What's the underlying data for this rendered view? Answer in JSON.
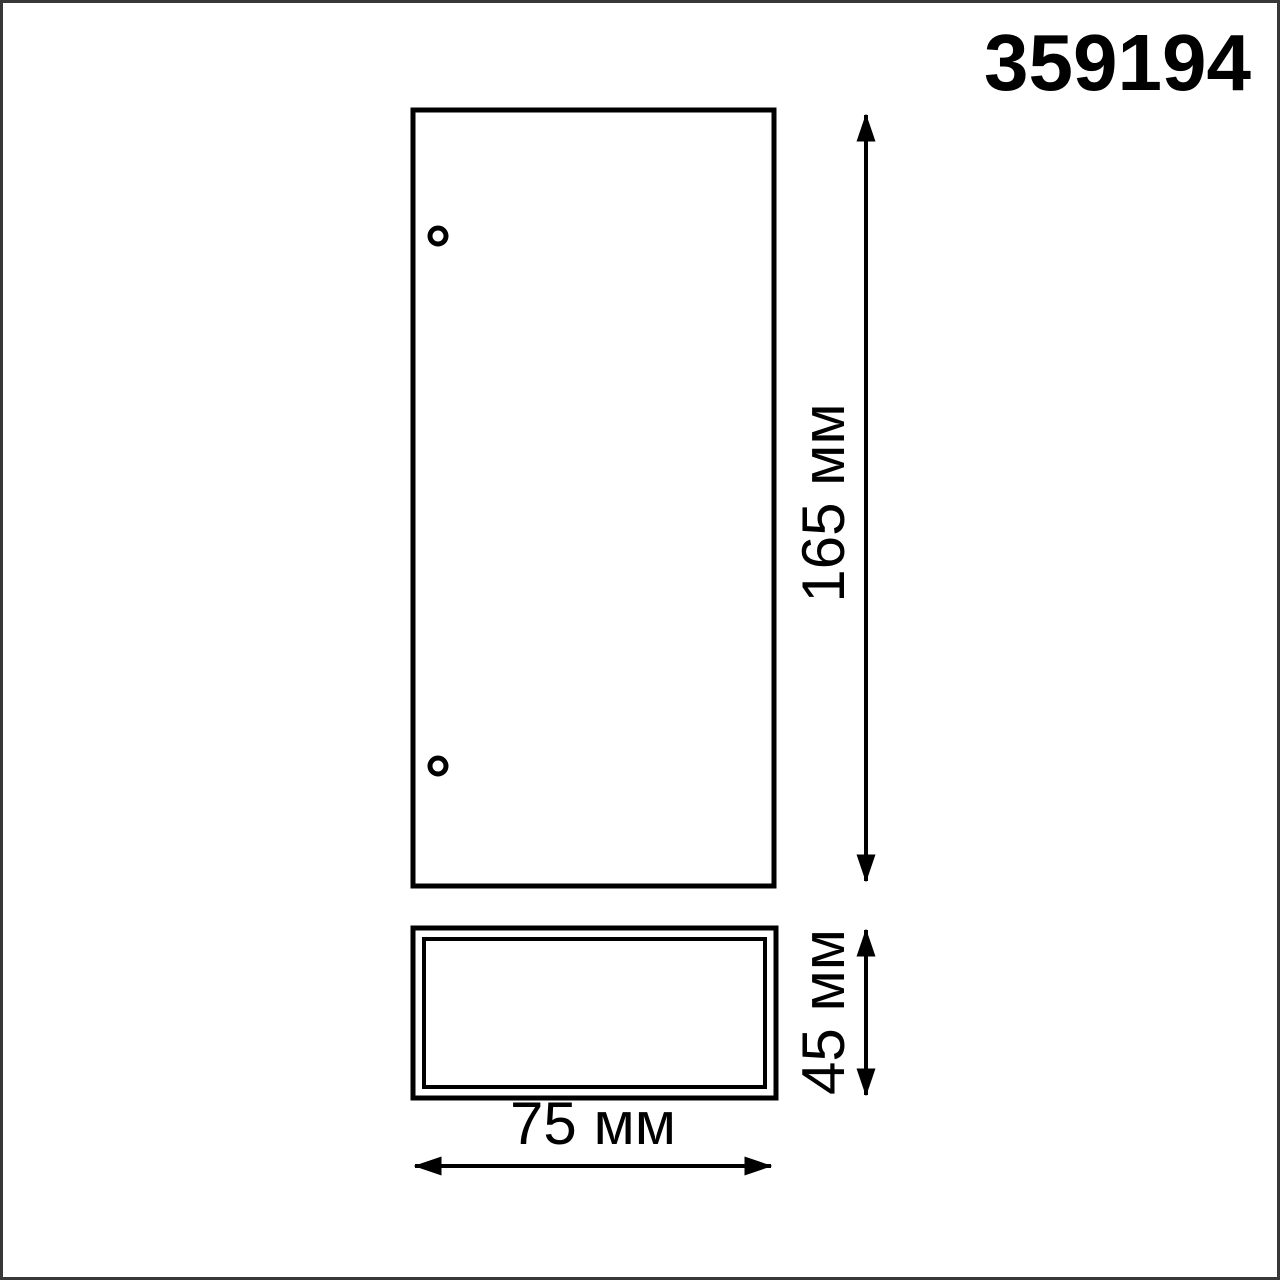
{
  "page": {
    "background": "#ffffff",
    "frame_color": "#383838",
    "line_color": "#000000"
  },
  "drawing": {
    "part_number": "359194",
    "dimensions": {
      "height": {
        "value": 165,
        "unit": "мм",
        "label": "165 мм"
      },
      "depth": {
        "value": 45,
        "unit": "мм",
        "label": "45 мм"
      },
      "width": {
        "value": 75,
        "unit": "мм",
        "label": "75 мм"
      }
    }
  }
}
